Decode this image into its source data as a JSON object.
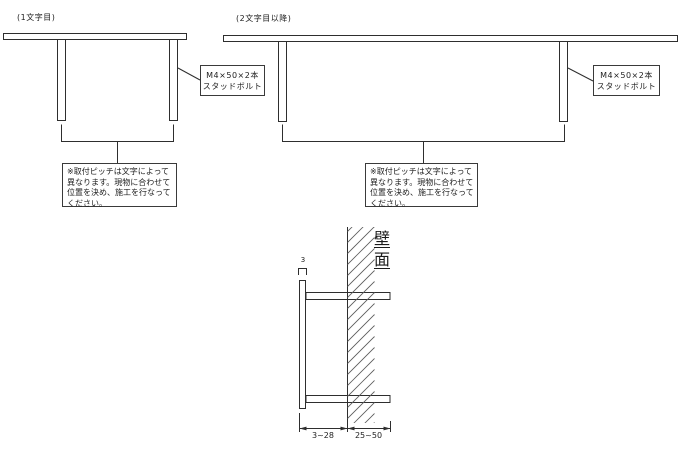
{
  "diagram1": {
    "caption": "(1文字目)",
    "bolt_label": "M4×50×2本\nスタッドボルト",
    "note": "※取付ピッチは文字によって\n異なります。現物に合わせて\n位置を決め、施工を行なって\nください。"
  },
  "diagram2": {
    "caption": "(2文字目以降)",
    "bolt_label": "M4×50×2本\nスタッドボルト",
    "note": "※取付ピッチは文字によって\n異なります。現物に合わせて\n位置を決め、施工を行なって\nください。"
  },
  "section_view": {
    "wall_label": "壁面",
    "plate_thickness": "3",
    "dim_plate_to_wall": "3~28",
    "dim_wall_depth": "25~50"
  },
  "colors": {
    "line": "#2e2e2e",
    "background": "#ffffff"
  }
}
